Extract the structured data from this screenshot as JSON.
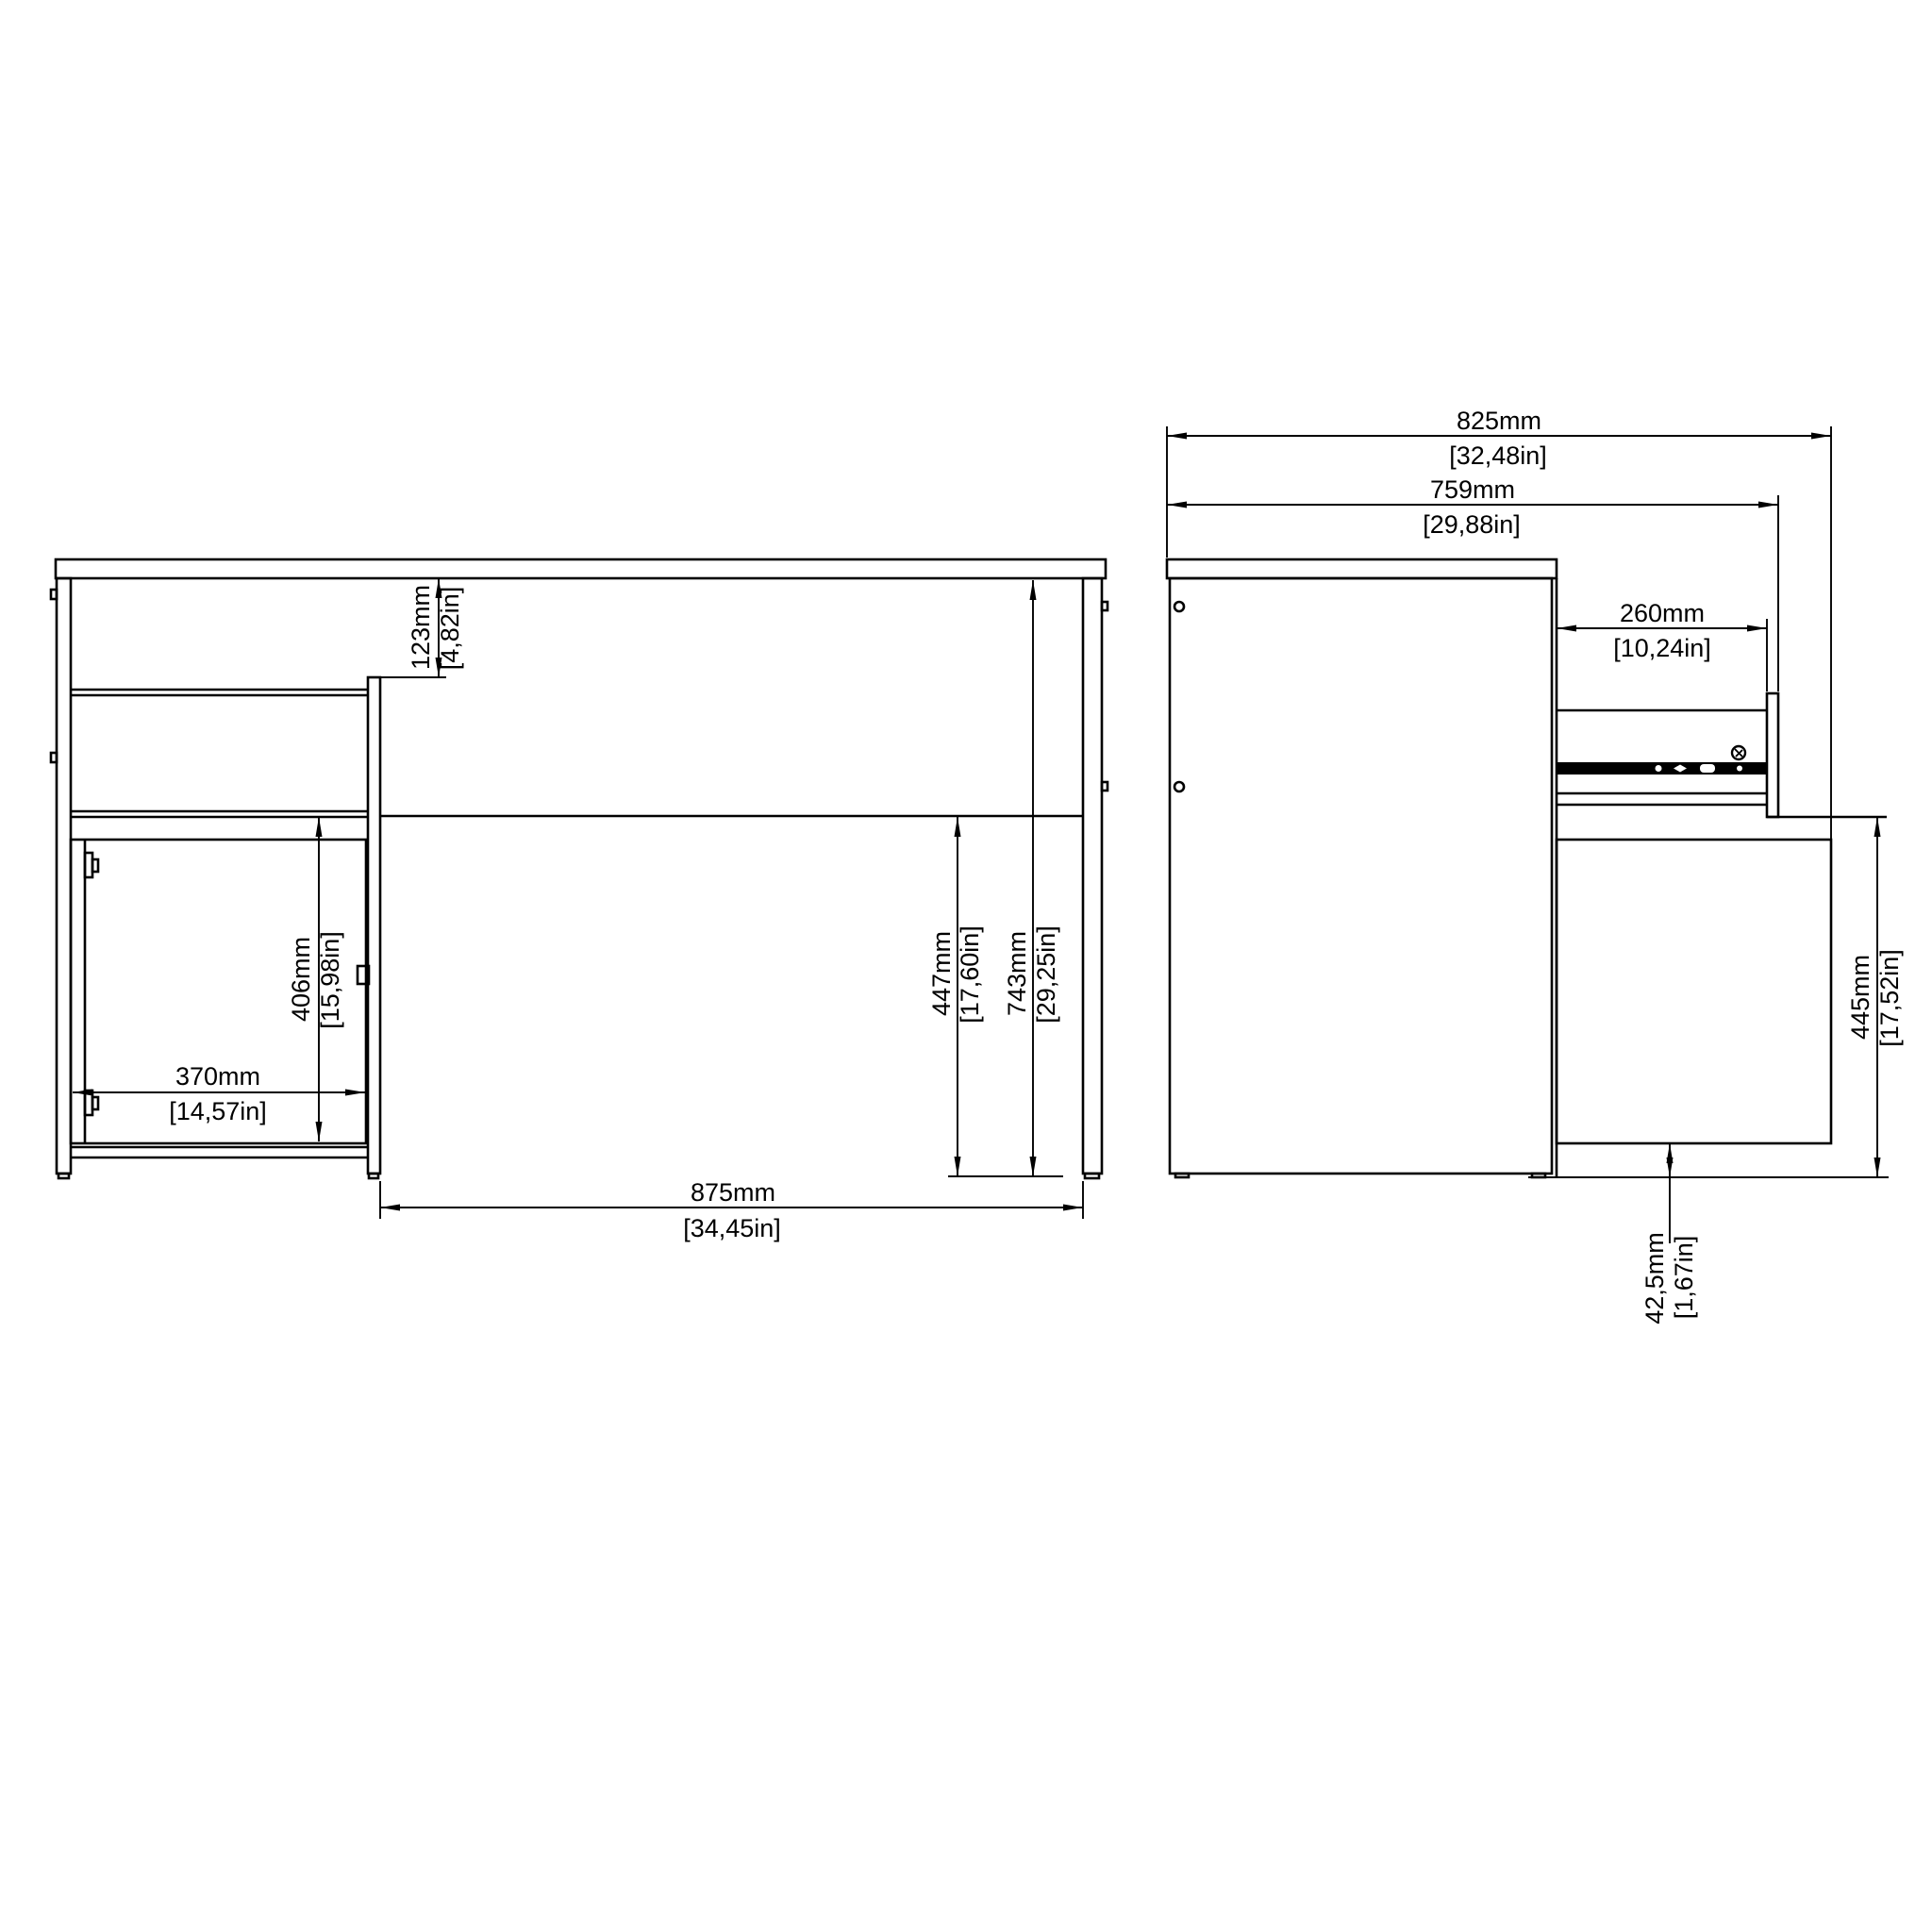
{
  "drawing": {
    "type": "furniture-technical-drawing",
    "subject": "desk with pedestal drawer and door, front and side elevation views",
    "background_color": "#ffffff",
    "line_color": "#000000"
  },
  "dims": {
    "d123": {
      "mm": "123mm",
      "inch": "[4,82in]"
    },
    "d406": {
      "mm": "406mm",
      "inch": "[15,98in]"
    },
    "d370": {
      "mm": "370mm",
      "inch": "[14,57in]"
    },
    "d447": {
      "mm": "447mm",
      "inch": "[17,60in]"
    },
    "d743": {
      "mm": "743mm",
      "inch": "[29,25in]"
    },
    "d875": {
      "mm": "875mm",
      "inch": "[34,45in]"
    },
    "d825": {
      "mm": "825mm",
      "inch": "[32,48in]"
    },
    "d759": {
      "mm": "759mm",
      "inch": "[29,88in]"
    },
    "d260": {
      "mm": "260mm",
      "inch": "[10,24in]"
    },
    "d445": {
      "mm": "445mm",
      "inch": "[17,52in]"
    },
    "d425": {
      "mm": "42,5mm",
      "inch": "[1,67in]"
    }
  }
}
